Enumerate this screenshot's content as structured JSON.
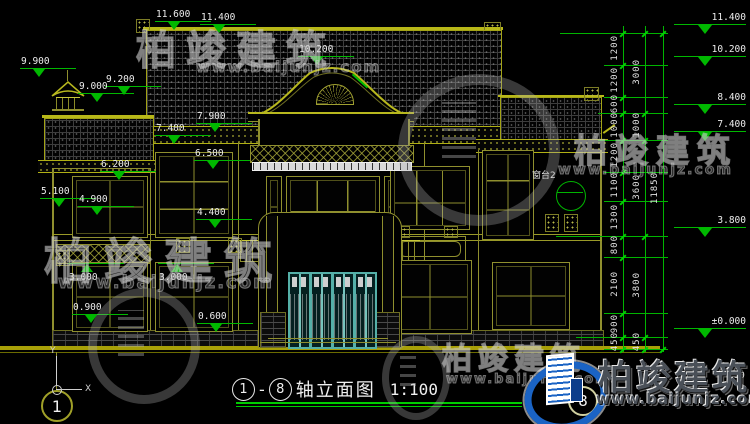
{
  "drawing": {
    "title": {
      "axis_start": "1",
      "separator": "-",
      "axis_end": "8",
      "name": "轴立面图",
      "scale": "1:100"
    },
    "axis_bubbles": {
      "left": "1",
      "right": "8"
    },
    "ucs": {
      "x": "X",
      "y": "Y"
    },
    "callouts": {
      "window_sill": "窗台2"
    },
    "elevations": {
      "e11_600": "11.600",
      "e11_400": "11.400",
      "e10_200": "10.200",
      "e9_900": "9.900",
      "e9_200": "9.200",
      "e9_000": "9.000",
      "e8_400": "8.400",
      "e7_900": "7.900",
      "e7_400": "7.400",
      "e6_500": "6.500",
      "e6_200": "6.200",
      "e5_100": "5.100",
      "e4_900": "4.900",
      "e4_400": "4.400",
      "e3_800": "3.800",
      "e3_000": "3.000",
      "e0_900": "0.900",
      "e0_600": "0.600",
      "e0_000": "±0.000",
      "e_frag": "50"
    },
    "dims": {
      "inner": [
        "1200",
        "1200",
        "600",
        "1000",
        "1200",
        "1100",
        "1300",
        "800",
        "2100",
        "900",
        "450"
      ],
      "middle": [
        "3000",
        "1000",
        "3600",
        "3800",
        "450"
      ],
      "total": "11850"
    }
  },
  "watermark": {
    "brand": "柏竣建筑",
    "url": "www.baijunjz.com"
  },
  "colors": {
    "background": "#000000",
    "facade_line": "#8f8f2e",
    "ridge_line": "#b8b818",
    "dimension_green": "#00b400",
    "text_white": "#ececec",
    "door_teal": "#55b0a8",
    "ground_yellow": "#a8a008",
    "logo_blue": "#1a63c4"
  }
}
